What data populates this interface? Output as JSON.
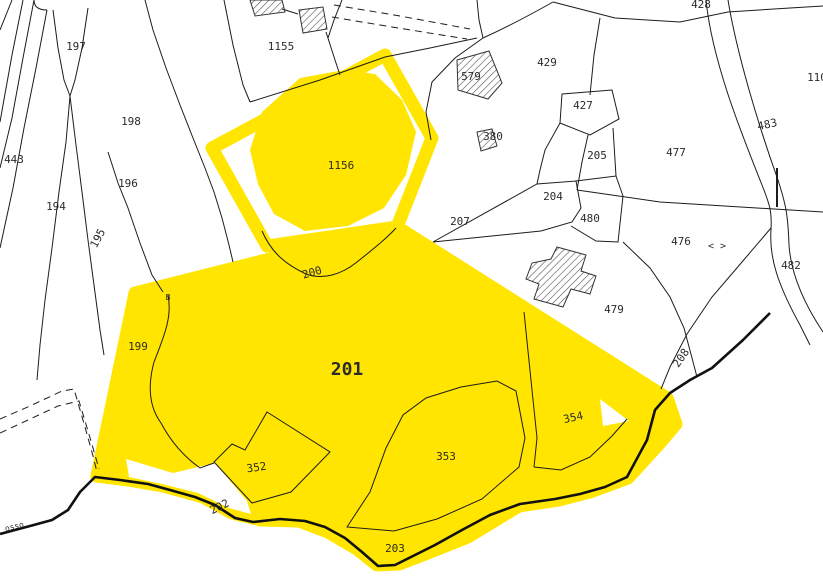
{
  "map": {
    "type": "cadastral-parcel-map",
    "canvas": {
      "width": 823,
      "height": 583
    },
    "colors": {
      "background": "#ffffff",
      "highlight": "#ffe500",
      "parcel_line": "#1c1c1c",
      "label": "#2b2b2b",
      "building_hatch": "#444444"
    },
    "highlighted_parcels": [
      "1156",
      "201"
    ],
    "parcels": [
      {
        "label": "197",
        "x": 76,
        "y": 50,
        "rot": 0,
        "size": 11
      },
      {
        "label": "198",
        "x": 131,
        "y": 125,
        "rot": 0,
        "size": 11
      },
      {
        "label": "443",
        "x": 14,
        "y": 163,
        "rot": 0,
        "size": 11
      },
      {
        "label": "196",
        "x": 128,
        "y": 187,
        "rot": 0,
        "size": 11
      },
      {
        "label": "194",
        "x": 56,
        "y": 210,
        "rot": 0,
        "size": 11
      },
      {
        "label": "195",
        "x": 101,
        "y": 240,
        "rot": -62,
        "size": 11
      },
      {
        "label": "199",
        "x": 138,
        "y": 350,
        "rot": 0,
        "size": 11
      },
      {
        "label": "1155",
        "x": 281,
        "y": 50,
        "rot": 0,
        "size": 11
      },
      {
        "label": "1156",
        "x": 341,
        "y": 169,
        "rot": 0,
        "size": 11
      },
      {
        "label": "200",
        "x": 313,
        "y": 276,
        "rot": -16,
        "size": 11
      },
      {
        "label": "201",
        "x": 347,
        "y": 375,
        "rot": 0,
        "size": 18,
        "bold": true
      },
      {
        "label": "352",
        "x": 257,
        "y": 471,
        "rot": -8,
        "size": 11
      },
      {
        "label": "353",
        "x": 446,
        "y": 460,
        "rot": 0,
        "size": 11
      },
      {
        "label": "354",
        "x": 574,
        "y": 421,
        "rot": -12,
        "size": 11
      },
      {
        "label": "202",
        "x": 221,
        "y": 510,
        "rot": -26,
        "size": 11
      },
      {
        "label": "203",
        "x": 395,
        "y": 552,
        "rot": 0,
        "size": 11
      },
      {
        "label": "207",
        "x": 460,
        "y": 225,
        "rot": 0,
        "size": 11
      },
      {
        "label": "204",
        "x": 553,
        "y": 200,
        "rot": 0,
        "size": 11
      },
      {
        "label": "205",
        "x": 597,
        "y": 159,
        "rot": 0,
        "size": 11
      },
      {
        "label": "427",
        "x": 583,
        "y": 109,
        "rot": 0,
        "size": 11
      },
      {
        "label": "429",
        "x": 547,
        "y": 66,
        "rot": 0,
        "size": 11
      },
      {
        "label": "579",
        "x": 471,
        "y": 80,
        "rot": 0,
        "size": 11
      },
      {
        "label": "380",
        "x": 493,
        "y": 140,
        "rot": 0,
        "size": 11
      },
      {
        "label": "480",
        "x": 590,
        "y": 222,
        "rot": 0,
        "size": 11
      },
      {
        "label": "476",
        "x": 681,
        "y": 245,
        "rot": 0,
        "size": 11
      },
      {
        "label": "477",
        "x": 676,
        "y": 156,
        "rot": 0,
        "size": 11
      },
      {
        "label": "479",
        "x": 614,
        "y": 313,
        "rot": 0,
        "size": 11
      },
      {
        "label": "482",
        "x": 791,
        "y": 269,
        "rot": 0,
        "size": 11
      },
      {
        "label": "483",
        "x": 768,
        "y": 128,
        "rot": -12,
        "size": 11
      },
      {
        "label": "428",
        "x": 701,
        "y": 8,
        "rot": 0,
        "size": 11
      },
      {
        "label": "110",
        "x": 817,
        "y": 81,
        "rot": 0,
        "size": 11
      },
      {
        "label": "208",
        "x": 684,
        "y": 360,
        "rot": -55,
        "size": 11
      }
    ],
    "annotations": [
      {
        "label": "osso",
        "x": 15,
        "y": 529,
        "rot": -14,
        "size": 8
      },
      {
        "label": "< >",
        "x": 717,
        "y": 249,
        "rot": 0,
        "size": 10
      },
      {
        "label": "B",
        "x": 168,
        "y": 300,
        "rot": 0,
        "size": 8
      }
    ]
  }
}
